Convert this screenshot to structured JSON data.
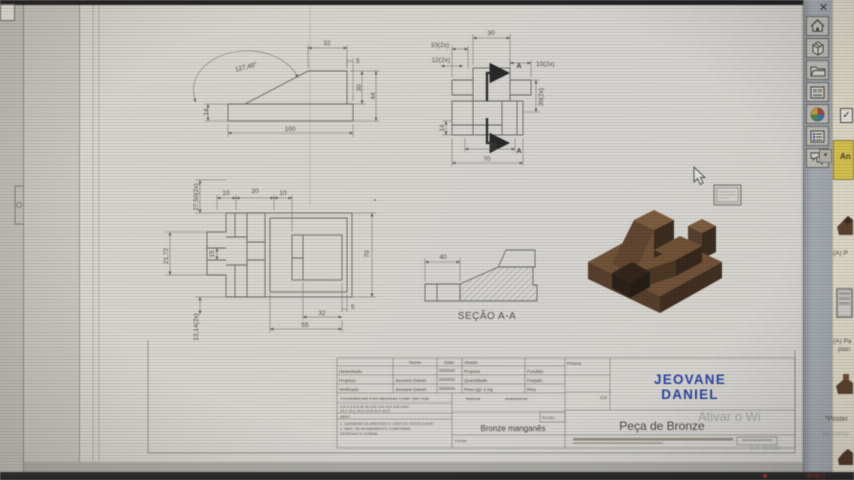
{
  "app": {
    "close_label": "✕",
    "taskbar_text": "MMC",
    "note_text": "An",
    "checkbox_glyph": "✓",
    "drop_widget_glyph": "▾",
    "toolbar_icons": [
      "home-icon",
      "package-icon",
      "folder-icon",
      "image-icon",
      "globe-icon",
      "list-icon",
      "comments-icon"
    ],
    "colors": {
      "part_bronze": "#5d3d22",
      "author_blue": "#1d3da8",
      "note_yellow": "#e3c83e",
      "taskbar_red": "#7e2013"
    }
  },
  "drawing": {
    "front_view": {
      "dim_top": "32",
      "dim_step": "5",
      "dim_angle": "127,48°",
      "dim_left": "14",
      "dim_bottom": "100",
      "dim_height_inner": "30",
      "dim_height_total": "44"
    },
    "plan_view": {
      "dim_top": "30",
      "dim_left_a": "10(2x)",
      "dim_left_b": "12(2x)",
      "dim_right_a": "10(2x)",
      "dim_right_b": "30(2x)",
      "dim_left_c": "14",
      "dim_bottom_inner": "50",
      "dim_bottom_total": "70",
      "section_a_top": "A",
      "section_a_bottom": "A"
    },
    "side_view": {
      "dim_v1": "27,50(2x)",
      "dim_t1": "10",
      "dim_t2": "20",
      "dim_t3": "10",
      "dim_v2": "21,72",
      "dim_v3": "15",
      "dim_v4": "70",
      "dim_b1": "5",
      "dim_b2": "32",
      "dim_b3": "55",
      "dim_v5": "13,14(2x)"
    },
    "section_view": {
      "caption": "SEÇÃO A-A",
      "dim": "40"
    }
  },
  "title_block": {
    "h_nome": "Nome",
    "h_data": "Data",
    "h_visado": "Visado",
    "h_pintura": "Pintura",
    "h_cor": "Cor",
    "r1_label": "Desenhado",
    "r2_label": "Projetou",
    "r3_label": "Verificado",
    "r2_name": "Jeovane Daniel",
    "r3_name": "Jeovane Daniel",
    "f1": "Propriet.",
    "f2": "Quantidade",
    "f3": "Peso (g):  1 Kg",
    "g1": "Fundido",
    "g2": "Forjado",
    "g3": "Req.",
    "tol_header": "TOLERÂNCIAS P/AS MEDIDAS CONF. DIN 7168",
    "tol_row1": "0,5-3   3-6   6-30   30-120   120-315   315-1000",
    "tol_row2": "±0,1   ±0,1   ±0,2   ±0,3   ±0,4   ±0,5",
    "tol_tag": "ABNT",
    "note1": "1. QUEBRAR AS ARESTAS E CANTOS VIVOS 0,5x45°",
    "note2": "2. MED. DE ACABAMENTO CONFORME",
    "note3": "    DESENHO E NORMA",
    "mat_label": "Material",
    "acab_label": "Acabamento",
    "material": "Bronze manganês",
    "escala_label": "Escala",
    "revisao_label": "Revisão",
    "author_line1": "JEOVANE",
    "author_line2": "DANIEL",
    "part_name": "Peça de Bronze"
  },
  "watermark": {
    "line1": "Ativar o Wi",
    "line2": "ao comp",
    "line3": "a o Windo"
  },
  "side_panel": {
    "caption1": "(A) P",
    "caption2": "(A) Pa",
    "caption2b": "plan",
    "caption3": "*Poster"
  }
}
